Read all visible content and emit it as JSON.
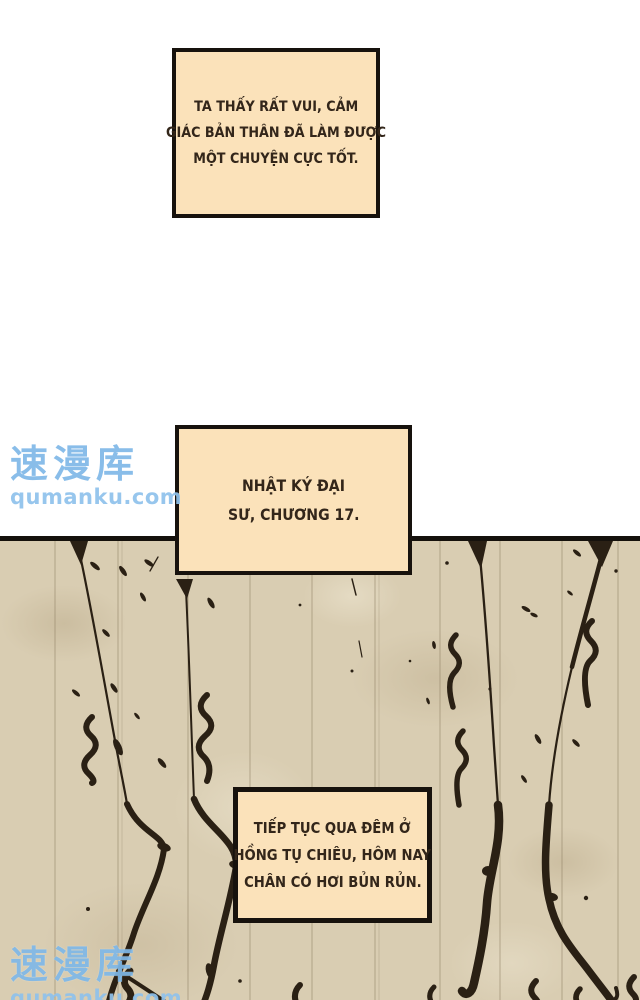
{
  "comic": {
    "narration_boxes": [
      {
        "name": "happy-thought",
        "lines": [
          "TA THẤY RẤT VUI, CẢM",
          "GIÁC BẢN THÂN ĐÃ LÀM ĐƯỢC",
          "MỘT CHUYỆN CỰC TỐT."
        ]
      },
      {
        "name": "diary-title",
        "lines": [
          "NHẬT KÝ ĐẠI",
          "SƯ, CHƯƠNG 17."
        ]
      },
      {
        "name": "diary-entry",
        "lines": [
          "TIẾP TỤC QUA ĐÊM Ở",
          "HỒNG TỤ CHIÊU, HÔM NAY",
          "CHÂN CÓ HƠI BỦN RỦN."
        ]
      }
    ],
    "watermark": {
      "logo": "速漫库",
      "site": "qumanku.com",
      "color": "#7fb8e8"
    },
    "colors": {
      "page_background": "#ffffff",
      "box_fill": "#fbe2ba",
      "box_border": "#17120d",
      "box_text": "#33261a",
      "panel_background": "#d9cdb2",
      "panel_border": "#15110c",
      "ink": "#2a2014"
    }
  }
}
